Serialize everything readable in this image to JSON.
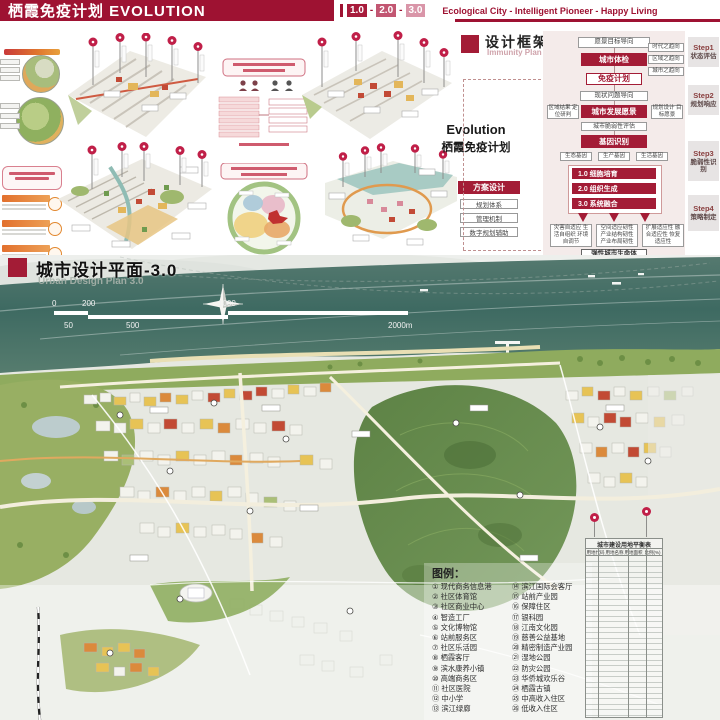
{
  "header": {
    "title": "栖霞免疫计划 EVOLUTION",
    "versions": [
      "1.0",
      "2.0",
      "3.0"
    ],
    "separator": "-",
    "tagline": "Ecological City - Intelligent Pioneer - Happy Living"
  },
  "framework": {
    "title": "设计框架",
    "subtitle": "Immunity Plan",
    "nodes": {
      "vision": "愿景目标导向",
      "checkup": "城市体检",
      "trend1": "时代之趋向",
      "trend2": "区域之趋向",
      "trend3": "城市之趋向",
      "immunity": "免疫计划",
      "problem": "现状问题导向",
      "dev_vision": "城市发展愿景",
      "side_left": "区域结果 定位研判",
      "side_right": "规划设计 目标愿景",
      "vulnerability": "城市脆弱性评估",
      "gene": "基因识别",
      "gene1": "生态基因",
      "gene2": "生产基因",
      "gene3": "生活基因",
      "stage1": "1.0 细胞培育",
      "stage2": "2.0 组织生成",
      "stage3": "3.0 系统融合",
      "adapt1": "灾害自适应 生活自组织 环境自调节",
      "adapt2": "空间适应韧性 产业结构韧性 产业布局韧性",
      "adapt3": "扩展适应性 融合适应性 恢复适应性",
      "outcome": "弹性城市生命体"
    },
    "steps": [
      {
        "step": "Step1",
        "label": "状态评估"
      },
      {
        "step": "Step2",
        "label": "规划响应"
      },
      {
        "step": "Step3",
        "label": "脆弱性识别"
      },
      {
        "step": "Step4",
        "label": "策略制定"
      }
    ]
  },
  "evolution": {
    "line1": "Evolution",
    "line2": "栖霞免疫计划"
  },
  "scheme": {
    "title": "方案设计",
    "item1": "规划体系",
    "item2": "管理机制",
    "item3": "数字规划辅助"
  },
  "plan": {
    "title": "城市设计平面-3.0",
    "subtitle": "Urban Design Plan 3.0",
    "scale_top1": "0",
    "scale_top2": "200",
    "scale_top3": "1000",
    "scale_bot1": "50",
    "scale_bot2": "500",
    "scale_bot3": "2000m"
  },
  "legend": {
    "title": "图例：",
    "col1": [
      "① 现代商务信息港",
      "② 社区体育馆",
      "③ 社区商业中心",
      "④ 智造工厂",
      "⑤ 文化博物馆",
      "⑥ 站前服务区",
      "⑦ 社区乐活园",
      "⑧ 栖霞客厅",
      "⑨ 滨水康养小镇",
      "⑩ 高端商务区",
      "⑪ 社区医院",
      "⑫ 中小学",
      "⑬ 滨江绿廊"
    ],
    "col2": [
      "⑭ 滨江国际会客厅",
      "⑮ 站前产业园",
      "⑯ 保障住区",
      "⑰ 银科园",
      "⑱ 江南文化园",
      "⑲ 慈善公益基地",
      "⑳ 精密制造产业园",
      "㉑ 湿地公园",
      "㉒ 防灾公园",
      "㉓ 华侨城欢乐谷",
      "㉔ 栖霞古镇",
      "㉕ 中高收入住区",
      "㉖ 低收入住区"
    ]
  },
  "table": {
    "title": "城市建设用地平衡表",
    "h1": "用地代码",
    "h2": "用地名称",
    "h3": "用地面积(hm²)",
    "h4": "比例(%)"
  }
}
